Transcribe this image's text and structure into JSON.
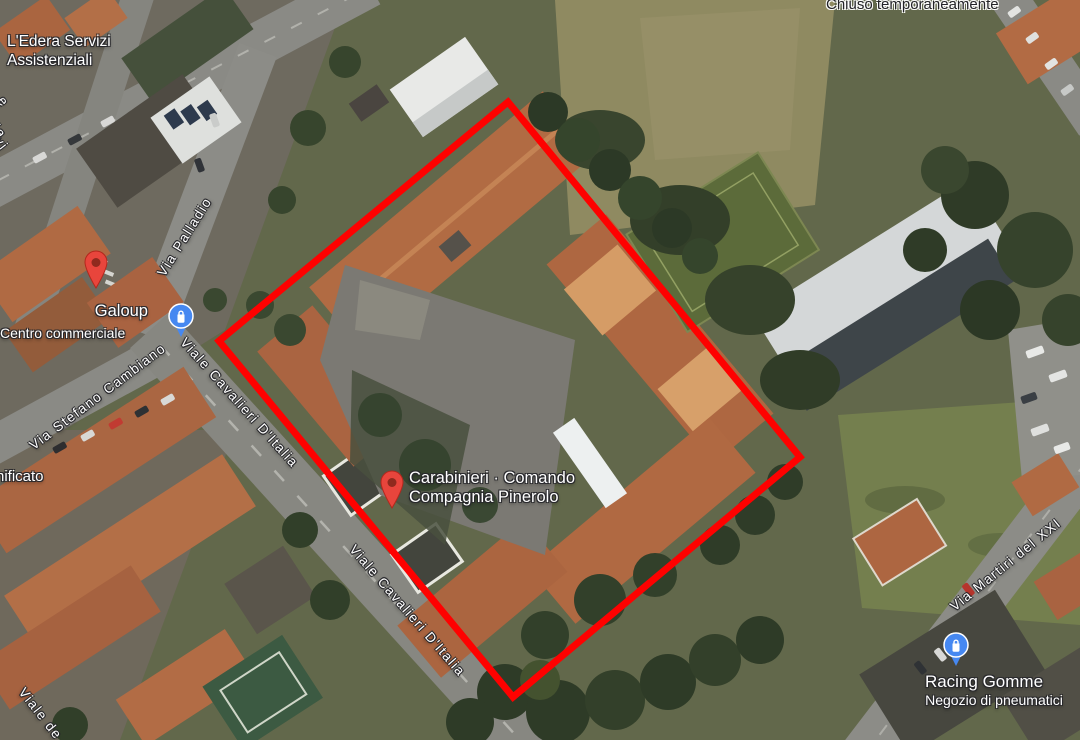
{
  "map": {
    "view": "satellite",
    "location": "Pinerolo, Italy"
  },
  "overlay": {
    "polygon_points": "508,102 800,457 513,697 219,341",
    "polygon_color": "#fe0100",
    "polygon_stroke_width": 7
  },
  "colors": {
    "pin_red": "#e8453c",
    "pin_red_inner": "#8f2a1e",
    "pin_blue": "#4688f1",
    "street_text": "#ffffff",
    "poi_text": "#ffffff",
    "notice_text": "#232327"
  },
  "pois": {
    "edera": {
      "line1": "L'Edera Servizi",
      "line2": "Assistenziali",
      "pin": "red-place-pin"
    },
    "galoup": {
      "title": "Galoup",
      "subtitle": "Centro commerciale",
      "pin": "blue-shopping-pin"
    },
    "carabinieri": {
      "line1": "Carabinieri · Comando",
      "line2": "Compagnia Pinerolo",
      "pin": "red-place-pin"
    },
    "racing": {
      "title": "Racing Gomme",
      "subtitle": "Negozio di pneumatici",
      "pin": "blue-shopping-pin"
    }
  },
  "notices": {
    "closed": "Chiuso temporaneamente"
  },
  "streets": {
    "palladio": "Via Palladio",
    "cambiano": "Via Stefano Cambiano",
    "cavalieri_a": "Viale Cavalieri D'Italia",
    "cavalieri_b": "Viale Cavalieri D'Italia",
    "martiri": "Via Martiri del XXI",
    "viale_de_partial": "Viale de"
  },
  "partial_labels": {
    "left_edge_1": "e",
    "left_edge_2": "della",
    "left_edge_3": "vi",
    "left_mid": "nificato"
  }
}
